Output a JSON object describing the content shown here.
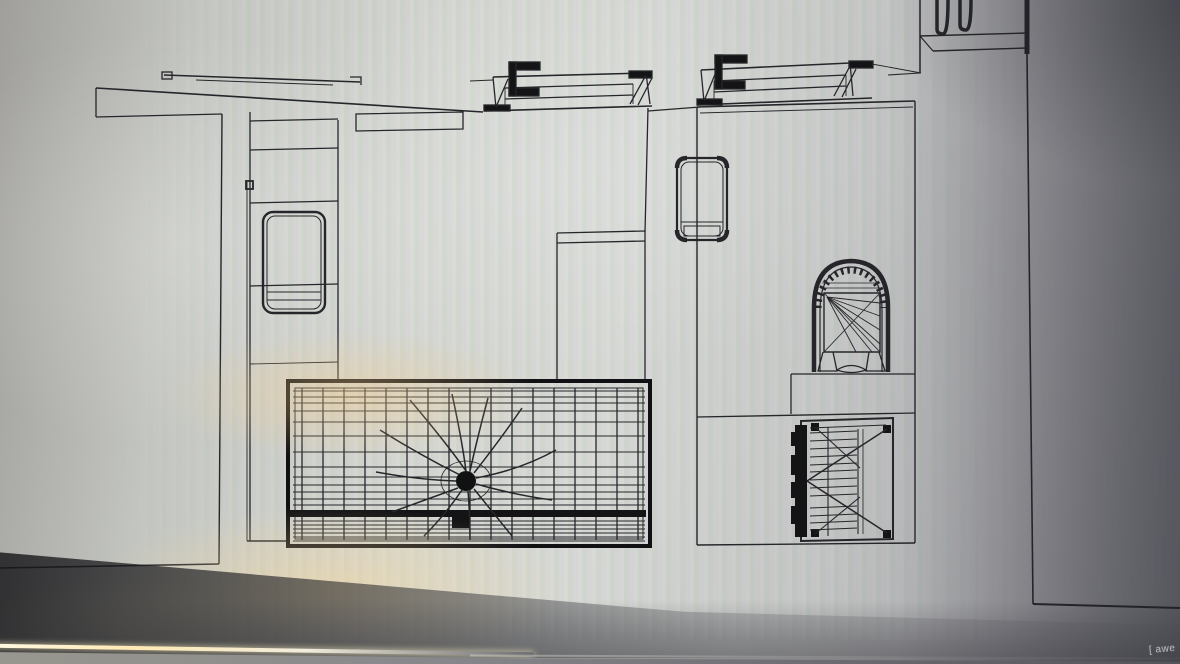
{
  "scene": {
    "description": "Photograph of a monitor displaying a black-and-white CAD wireframe floor plan",
    "watermark": "[ awe"
  },
  "colors": {
    "line": "#26262a",
    "ink_heavy": "#141416",
    "screen_light": "#d6d8d4",
    "screen_dark_right": "#828288",
    "glare_warm": "#f8ce8c",
    "desk_edge_highlight": "#fff8e2",
    "desk_surface": "#87878b",
    "watermark_text": "#c4c4c9"
  },
  "elements": [
    "door-track",
    "wall-band",
    "left-room",
    "wardrobe-panel",
    "cabinet-door",
    "counter",
    "window-symbol-a",
    "window-symbol-b",
    "center-island",
    "net-grid",
    "net-center-node",
    "right-room",
    "armchair",
    "arched-fixture",
    "platform",
    "slatted-bench",
    "corner-window-symbol",
    "right-partition"
  ]
}
